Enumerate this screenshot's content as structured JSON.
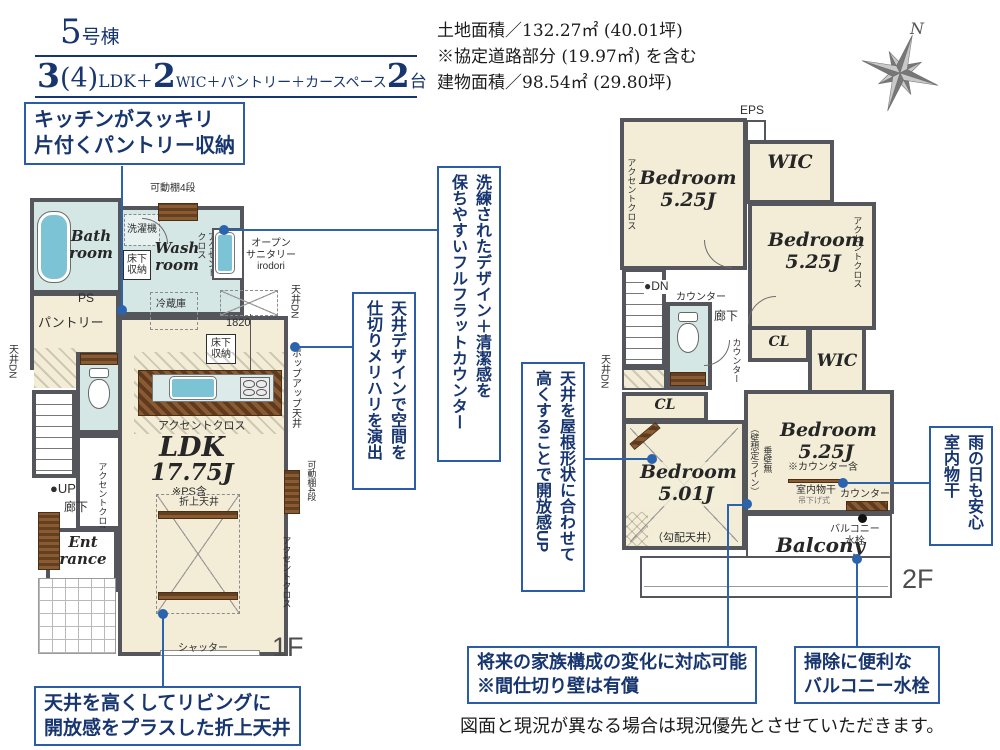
{
  "header": {
    "unit_number": "5",
    "unit_suffix": "号棟",
    "plan": {
      "n1": "3",
      "n2": "(4)",
      "t1": "LDK＋",
      "n3": "2",
      "t2": "WIC＋パントリー＋カースペース",
      "n4": "2",
      "t3": "台"
    }
  },
  "site_info": {
    "line1": "土地面積／132.27㎡ (40.01坪)",
    "line2": "※協定道路部分 (19.97㎡) を含む",
    "line3": "建物面積／98.54㎡ (29.80坪)"
  },
  "compass": {
    "label": "N"
  },
  "floor1": {
    "title": "1F",
    "shelf_top": "可動棚4段",
    "washer": "洗濯機",
    "bath": "Bath\nroom",
    "wash": "Wash\nroom",
    "underfloor1": "床下\n収納",
    "accent_wash": "アクセント\nクロス",
    "open_sanitary": "オープン\nサニタリー\nirodori",
    "ceiling_dn_left": "天井DN",
    "ceiling_dn_right": "天井DN",
    "ps": "PS",
    "pantry": "パントリー",
    "counter_v": "カウンター",
    "fridge": "冷蔵庫",
    "dim": "1820",
    "underfloor2": "床下\n収納",
    "popup": "ポップアップ天井",
    "accent_kitchen": "アクセントクロス",
    "ldk": "LDK",
    "ldk_size": "17.75J",
    "ps_incl": "※PS含",
    "folded": "折上天井",
    "up": "●UP",
    "hall": "廊下",
    "accent_hall": "アクセントクロス",
    "entrance": "Ent\nrance",
    "accent_right": "アクセントクロス",
    "shelf_right": "可動棚4段",
    "shutter": "シャッター"
  },
  "floor2": {
    "title": "2F",
    "eps": "EPS",
    "wic1": "WIC",
    "bed1": "Bedroom\n5.25J",
    "accent_left": "アクセントクロス",
    "bed2": "Bedroom\n5.25J",
    "accent_right": "アクセントクロス",
    "dn": "●DN",
    "counter1": "カウンター",
    "hall": "廊下",
    "counter_v": "カウンター",
    "ceiling_dn": "天井DN",
    "cl1": "CL",
    "wic2": "WIC",
    "cl2": "CL",
    "bed3": "Bedroom\n5.25J",
    "bed3_note": "※カウンター含",
    "monohoshi": "室内物干",
    "monohoshi2": "吊下げ式",
    "counter2": "カウンター",
    "wall_line": "（壁想定ライン）",
    "tarekabe": "垂壁無",
    "bed4": "Bedroom\n5.01J",
    "slope": "（勾配天井）",
    "balcony": "Balcony",
    "faucet": "バルコニー\n水栓"
  },
  "callouts": {
    "kitchen_pantry": "キッチンがスッキリ\n片付くパントリー収納",
    "flat_counter": "洗練されたデザイン＋清潔感を\n保ちやすいフルフラットカウンター",
    "ceiling_design": "天井デザインで空間を\n仕切りメリハリを演出",
    "folded_ceiling": "天井を高くしてリビングに\n開放感をプラスした折上天井",
    "roof_shape": "天井を屋根形状に合わせて\n高くすることで開放感UP",
    "indoor_drying": "雨の日も安心\n室内物干",
    "partition": "将来の家族構成の変化に対応可能\n※間仕切り壁は有償",
    "balcony_faucet": "掃除に便利な\nバルコニー水栓"
  },
  "footer": "図面と現況が異なる場合は現況優先とさせていただきます。"
}
